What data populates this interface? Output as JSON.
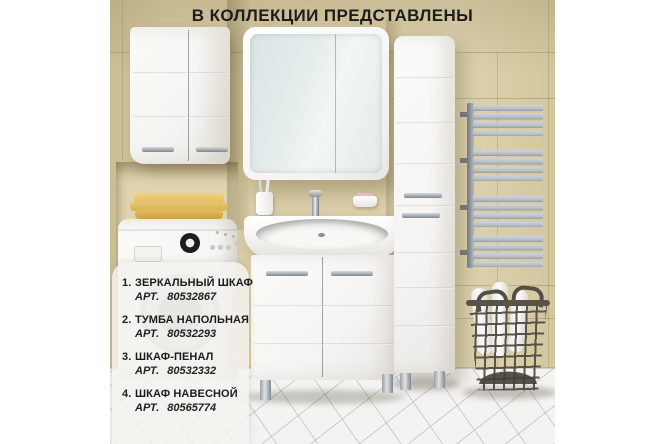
{
  "title": "В КОЛЛЕКЦИИ ПРЕДСТАВЛЕНЫ",
  "panel": {
    "items": [
      {
        "num": "1.",
        "name": "ЗЕРКАЛЬНЫЙ ШКАФ",
        "art_label": "АРТ.",
        "art_number": "80532867"
      },
      {
        "num": "2.",
        "name": "ТУМБА НАПОЛЬНАЯ",
        "art_label": "АРТ.",
        "art_number": "80532293"
      },
      {
        "num": "3.",
        "name": "ШКАФ-ПЕНАЛ",
        "art_label": "АРТ.",
        "art_number": "80532332"
      },
      {
        "num": "4.",
        "name": "ШКАФ НАВЕСНОЙ",
        "art_label": "АРТ.",
        "art_number": "80565774"
      }
    ]
  },
  "scene": {
    "objects": [
      "mirror-cabinet",
      "wall-cabinet",
      "tall-cabinet",
      "vanity-with-sink",
      "washing-machine",
      "towel-radiator",
      "laundry-basket",
      "yellow-towels",
      "toothbrush-cup",
      "soap-dish",
      "faucet"
    ],
    "colors": {
      "wall": "#d7cba4",
      "wall_dark": "#c8ba92",
      "niche": "#e0d5b0",
      "floor": "#f4f3f1",
      "furniture_white": "#f8f8f6",
      "mirror_glass": "#e6eeed",
      "radiator": "#b6bcc4",
      "basket_wire": "#5f5b53",
      "towel_yellow": "#ecc976",
      "soap_pink": "#e7b9c6",
      "title_text": "#1d1d1d",
      "panel_bg": "rgba(243,242,239,0.85)"
    }
  }
}
